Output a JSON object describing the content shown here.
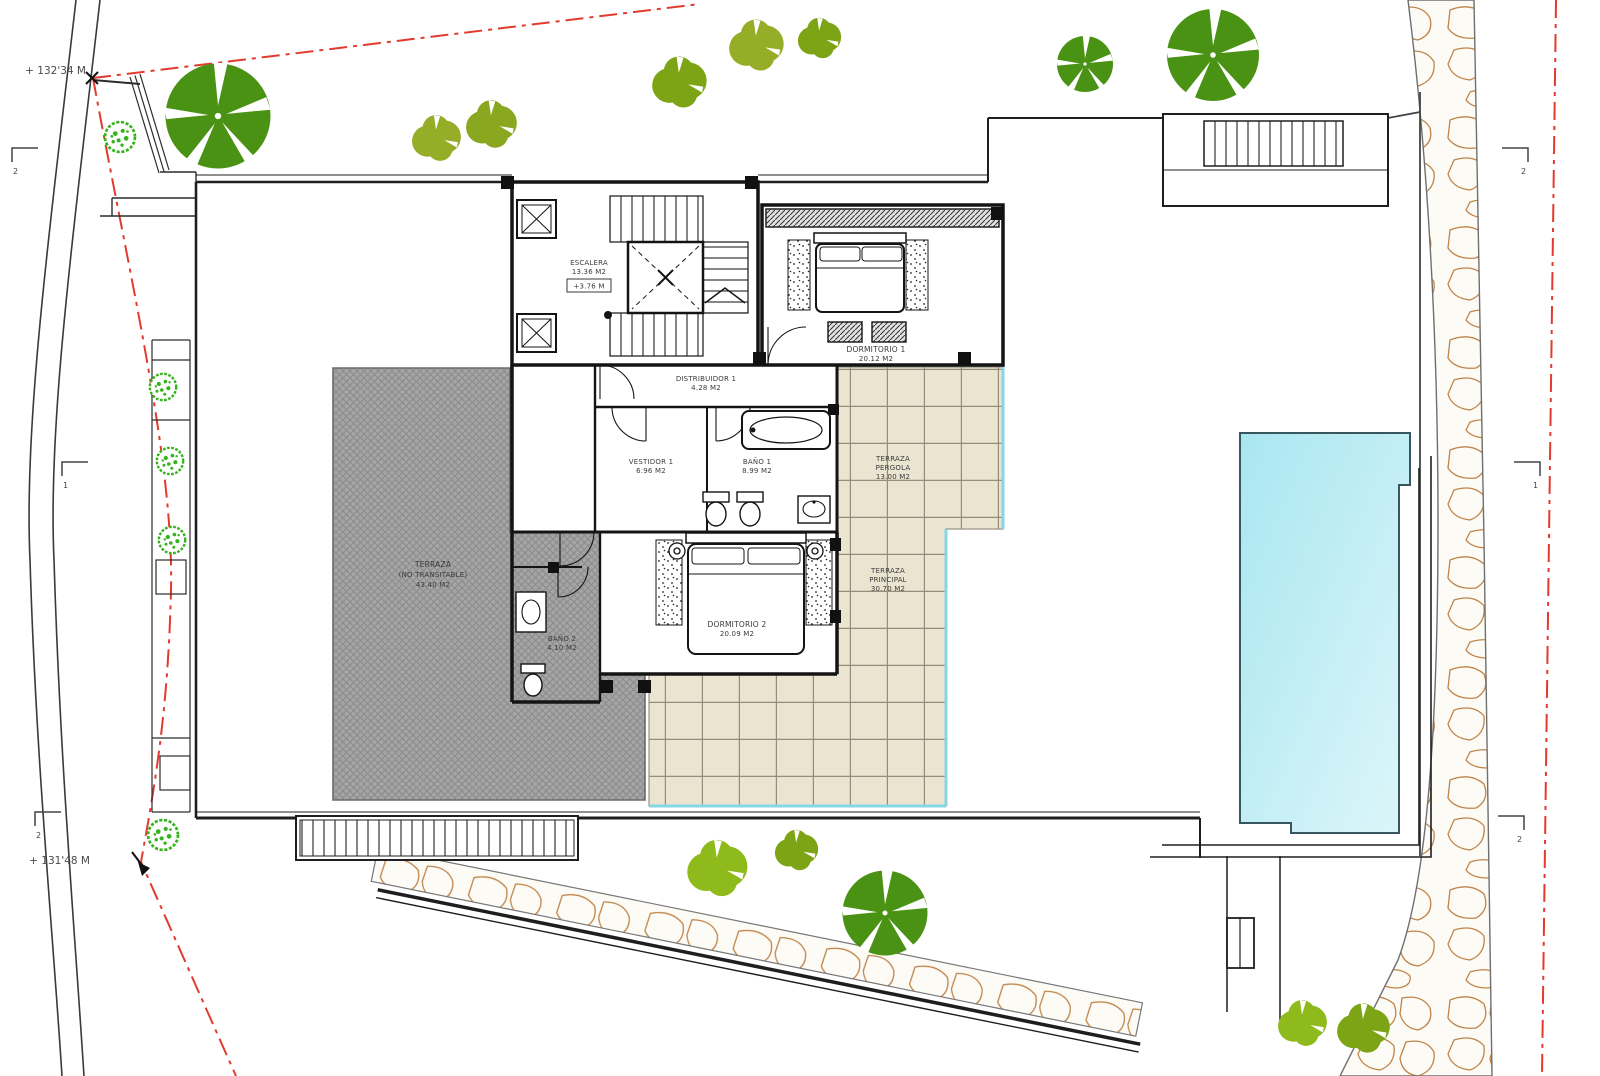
{
  "drawing": {
    "type": "architectural-site-plan",
    "description": "Villa upper floor plan with pool, terraces, gardens and paths"
  },
  "rooms": [
    {
      "id": "escalera",
      "name": "ESCALERA",
      "area": "13.36 M2",
      "level": "+3.76 M"
    },
    {
      "id": "distribuidor",
      "name": "DISTRIBUIDOR 1",
      "area": "4.28 M2"
    },
    {
      "id": "dormitorio1",
      "name": "DORMITORIO 1",
      "area": "20.12 M2"
    },
    {
      "id": "vestidor1",
      "name": "VESTIDOR 1",
      "area": "6.96 M2"
    },
    {
      "id": "bano1",
      "name": "BAÑO 1",
      "area": "8.99 M2"
    },
    {
      "id": "terraza_pergola",
      "name": "TERRAZA",
      "sub": "PERGOLA",
      "area": "13.00 M2"
    },
    {
      "id": "terraza_principal",
      "name": "TERRAZA",
      "sub": "PRINCIPAL",
      "area": "30.70 M2"
    },
    {
      "id": "dormitorio2",
      "name": "DORMITORIO 2",
      "area": "20.09 M2"
    },
    {
      "id": "bano2",
      "name": "BAÑO 2",
      "area": "4.10 M2"
    },
    {
      "id": "cubierta",
      "name": "TERRAZA",
      "sub": "(NO TRANSITABLE)",
      "area": "43.40 M2"
    }
  ],
  "site": {
    "elevation_markers": [
      {
        "label": "+ 132'34 M"
      },
      {
        "label": "+ 131'48 M"
      }
    ],
    "section_markers_left": [
      {
        "num": "2"
      },
      {
        "num": "1"
      },
      {
        "num": "2"
      }
    ],
    "section_markers_right": [
      {
        "num": "2"
      },
      {
        "num": "1"
      },
      {
        "num": "2"
      }
    ]
  },
  "icons": {
    "pool": "swimming-pool",
    "trees_dark": "tree-canopy-icon",
    "trees_bright": "shrub-mosaic-icon",
    "trees_olive": "bush-icon",
    "stone_path": "cobblestone-path"
  },
  "colors": {
    "wall": "#1f1f1f",
    "boundary_red": "#e23b2e",
    "pool_water": "#b9ebf4",
    "tile": "#eae4d0",
    "roof_gray": "#a5a5a5",
    "tree_dark": "#4a9214",
    "tree_bright": "#35b31c",
    "tree_olive": "#96ad27",
    "stone": "#c08448"
  }
}
